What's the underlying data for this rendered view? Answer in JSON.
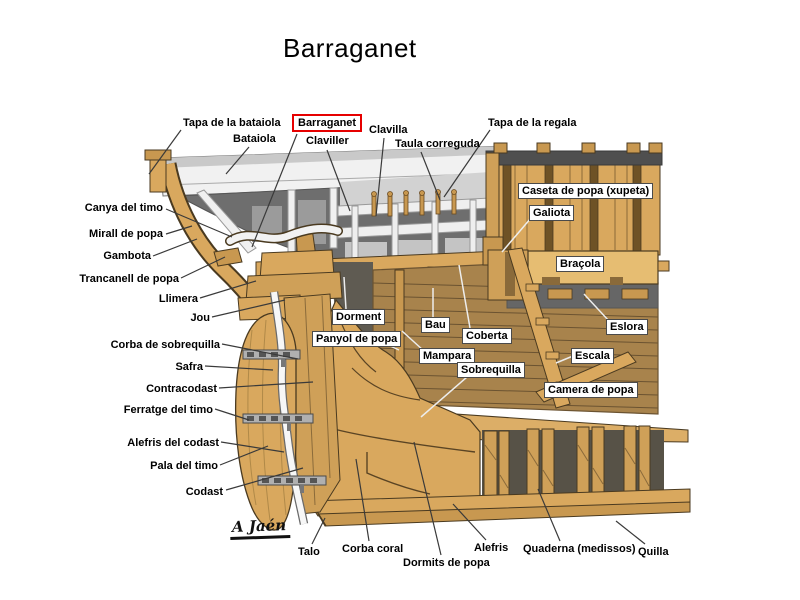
{
  "title": "Barraganet",
  "signature": "A Jaén",
  "colors": {
    "highlight_box": "#e60000",
    "wood_light": "#d9a85e",
    "wood_mid": "#c89850",
    "wood_plank_wall": "#a8834c",
    "panel_gray": "#6e6e6e",
    "bulwark_white": "#f1f1f1",
    "leader_dark": "#3a3a3a",
    "leader_light": "#ededed"
  },
  "labels": {
    "tapa_bataiola": "Tapa de la bataiola",
    "barraganet": "Barraganet",
    "bataiola": "Bataiola",
    "claviller": "Claviller",
    "clavilla": "Clavilla",
    "taula_correguda": "Taula correguda",
    "tapa_regala": "Tapa de la regala",
    "caseta": "Caseta de popa (xupeta)",
    "galiota": "Galiota",
    "bracola": "Braçola",
    "canya_timo": "Canya del timo",
    "mirall_popa": "Mirall de popa",
    "gambota": "Gambota",
    "trancanell": "Trancanell de popa",
    "llimera": "Llimera",
    "jou": "Jou",
    "dorment": "Dorment",
    "bau": "Bau",
    "coberta": "Coberta",
    "eslora": "Eslora",
    "panyol": "Panyol de popa",
    "mampara": "Mampara",
    "escala": "Escala",
    "corba_sobrequilla": "Corba de sobrequilla",
    "sobrequilla": "Sobrequilla",
    "safra": "Safra",
    "contracodast": "Contracodast",
    "camera_popa": "Camera de popa",
    "ferratge_timo": "Ferratge del timo",
    "alefris_codast": "Alefris del codast",
    "pala_timo": "Pala del timo",
    "codast": "Codast",
    "talo": "Talo",
    "corba_coral": "Corba coral",
    "dormits_popa": "Dormits de popa",
    "alefris": "Alefris",
    "quaderna": "Quaderna (medissos)",
    "quilla": "Quilla"
  }
}
